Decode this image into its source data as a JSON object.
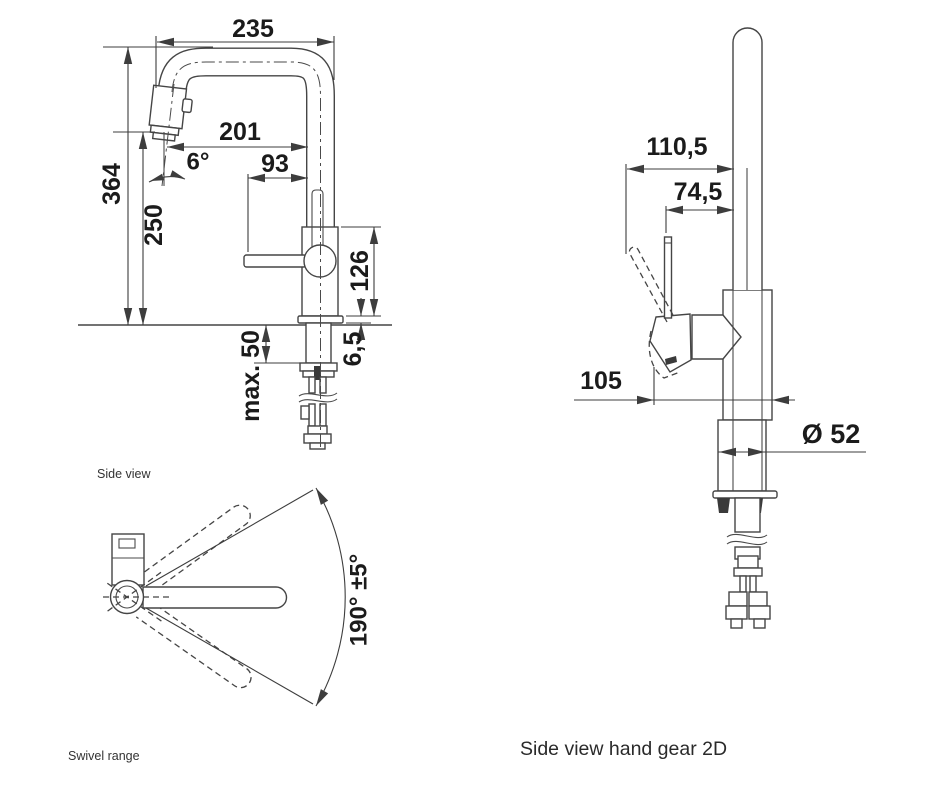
{
  "colors": {
    "line": "#454545",
    "dimension": "#3d3d3d",
    "text": "#1b1b1b"
  },
  "front_view": {
    "caption": "Side view",
    "dims": {
      "top_width": "235",
      "total_height": "364",
      "outlet_height": "250",
      "reach": "201",
      "handle_offset": "93",
      "outlet_angle": "6°",
      "body_height": "126",
      "base_plate": "6,5",
      "max_deck": "max. 50"
    }
  },
  "side_view": {
    "caption": "Side view hand gear 2D",
    "dims": {
      "lever_forward": "110,5",
      "lever_up": "74,5",
      "body_depth": "105",
      "base_diameter": "Ø 52"
    }
  },
  "swivel_view": {
    "caption": "Swivel range",
    "dims": {
      "swivel_angle": "190° ±5°"
    }
  }
}
